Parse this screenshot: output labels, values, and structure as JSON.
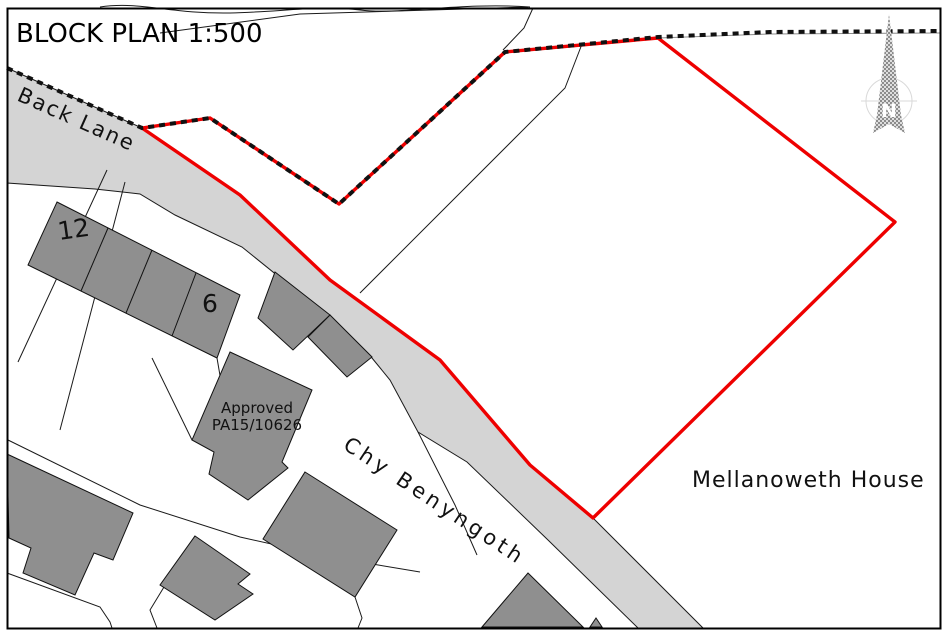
{
  "map": {
    "title": "BLOCK PLAN 1:500",
    "scale": "1:500",
    "labels": {
      "road": "Back Lane",
      "street": "Chy Benyngoth",
      "neighbour_house": "Mellanoweth House",
      "house_number_12": "12",
      "house_number_6": "6",
      "approved_line1": "Approved",
      "approved_line2": "PA15/10626",
      "north": "N"
    },
    "legend": {
      "red_outline_meaning": "site boundary",
      "icons": [
        "north-arrow-icon"
      ]
    }
  },
  "colors": {
    "boundary": "#ee0000",
    "road": "#d4d4d4",
    "building": "#8f8f8f",
    "dashes": "#111111",
    "frame": "#000000",
    "background": "#ffffff"
  }
}
